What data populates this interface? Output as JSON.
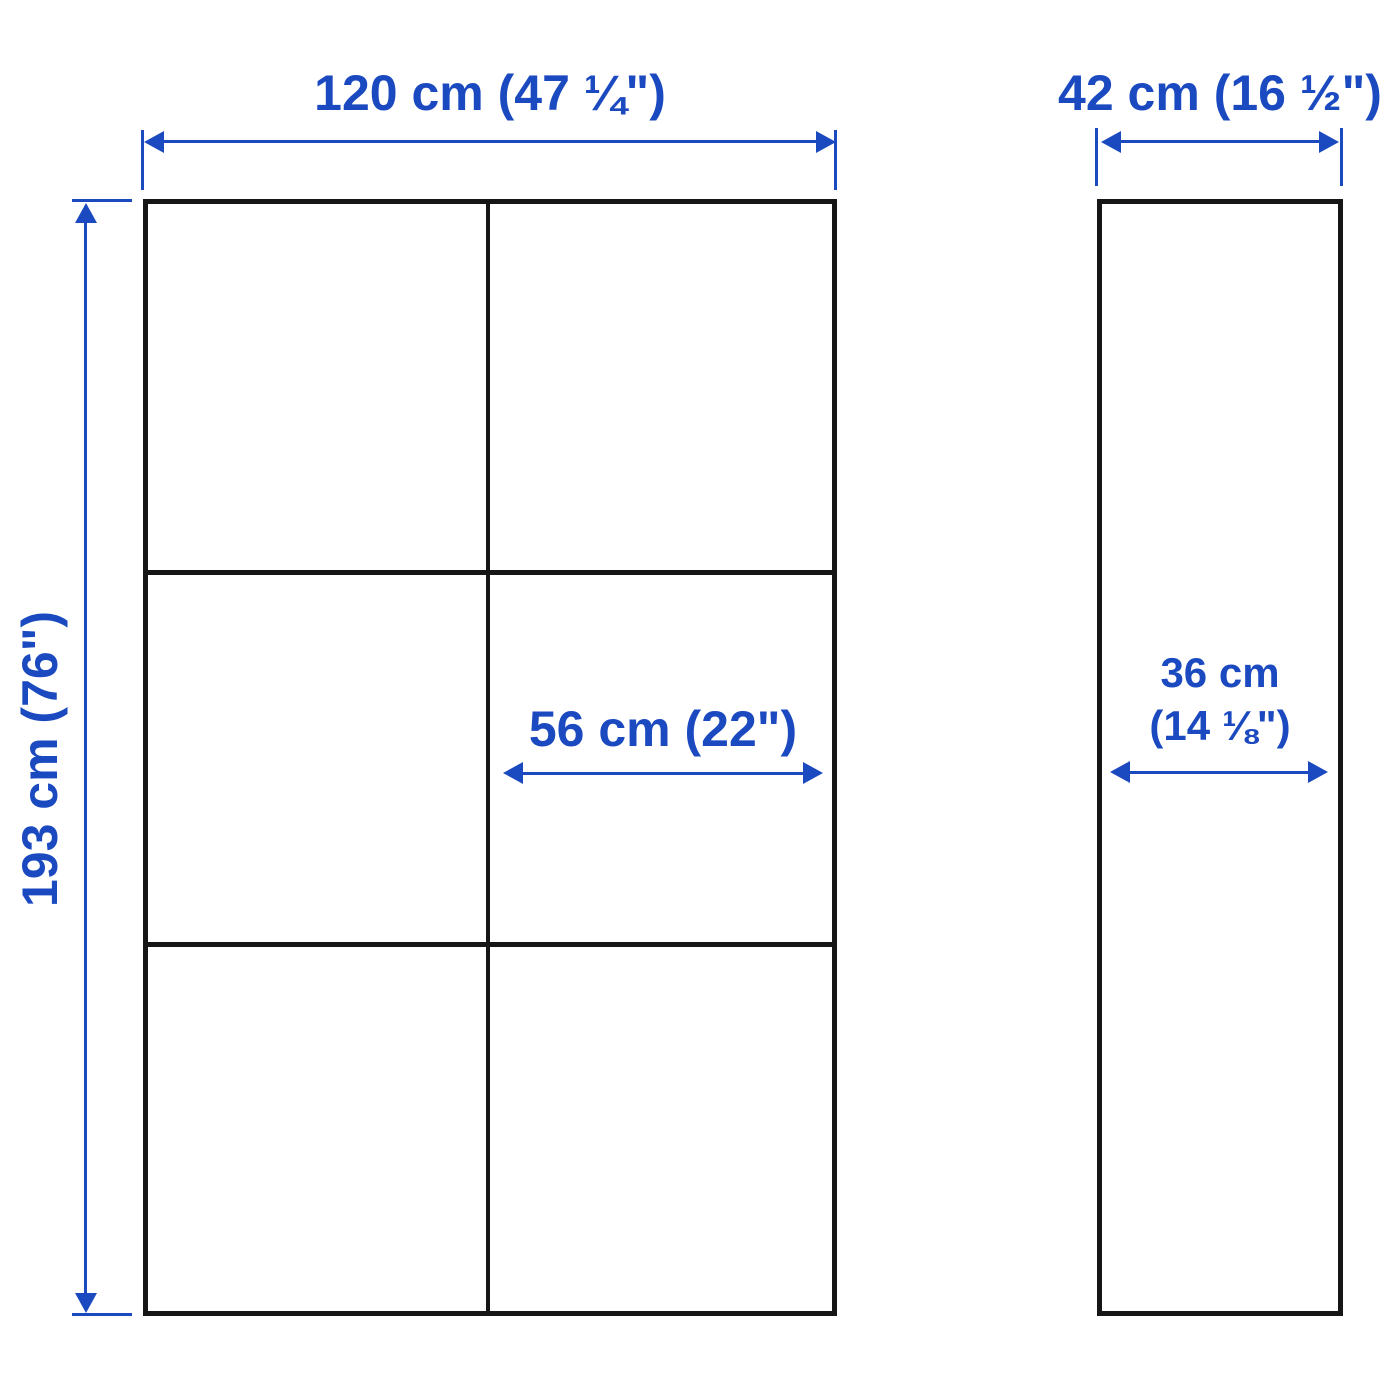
{
  "diagram": {
    "type": "product-dimension-drawing",
    "views": {
      "front": {
        "rows": 3,
        "columns": 2
      },
      "side": {
        "panels": 1
      }
    },
    "dimensions": {
      "front_width": {
        "label": "120 cm (47 ¼\")"
      },
      "front_height": {
        "label": "193 cm (76\")"
      },
      "compartment_width": {
        "label": "56 cm (22\")"
      },
      "side_width": {
        "label": "42 cm (16 ½\")"
      },
      "side_depth": {
        "line1": "36 cm",
        "line2": "(14 ⅛\")"
      }
    },
    "colors": {
      "dimension": "#1b4ac0",
      "outline": "#161616",
      "background": "#ffffff"
    }
  }
}
